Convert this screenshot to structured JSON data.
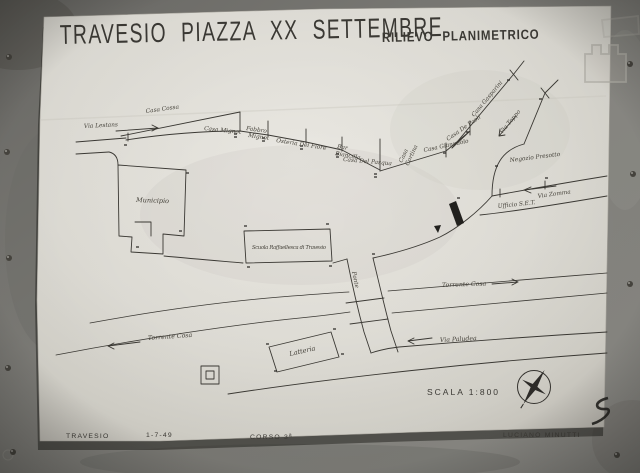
{
  "photo": {
    "title": "TRAVESIO PIAZZA XX SETTEMBRE",
    "subtitle": "RILIEVO PLANIMETRICO"
  },
  "map_labels": {
    "via_lestans": "Via Lestans",
    "casa_cossa": "Casa Cossa",
    "casa_mignot": "Casa Mignot",
    "fabbro_line1": "Fabbro",
    "fabbro_line2": "Mignot",
    "osteria_del_fiore": "Osteria Del Fiore",
    "bar_line1": "Bar",
    "bar_line2": "Biancilla",
    "casa_del_pasqua": "Casa Del Pasqua",
    "casa_cortina_line1": "Casa",
    "casa_cortina_line2": "Cortina",
    "casa_gianpaolo": "Casa Gianpaolo",
    "casa_de_paoli": "Casa De Paoli",
    "casa_gasparini": "Casa Gasparini",
    "via_toppo": "Via Toppo",
    "negozio_presotto": "Negozio Presotto",
    "via_zomma": "Via Zomma",
    "ufficio_set": "Ufficio S.E.T.",
    "municipio": "Municipio",
    "scuola": "Scuola Raffaellesca di Travesio",
    "ponte": "Ponte",
    "torrente_cosa_left": "Torrente Cosa",
    "torrente_cosa_right": "Torrente Cosa",
    "latteria": "Latteria",
    "via_paludea": "Via Paludea",
    "scale_text": "SCALA 1:800"
  },
  "footer": {
    "place": "TRAVESIO",
    "date": "1-7-49",
    "course": "CORSO 3ª",
    "author": "LUCIANO MINUTTI"
  },
  "colors": {
    "ink": "#3b3934",
    "paper": "#e6e4dd",
    "wall": "#7d7c78"
  }
}
